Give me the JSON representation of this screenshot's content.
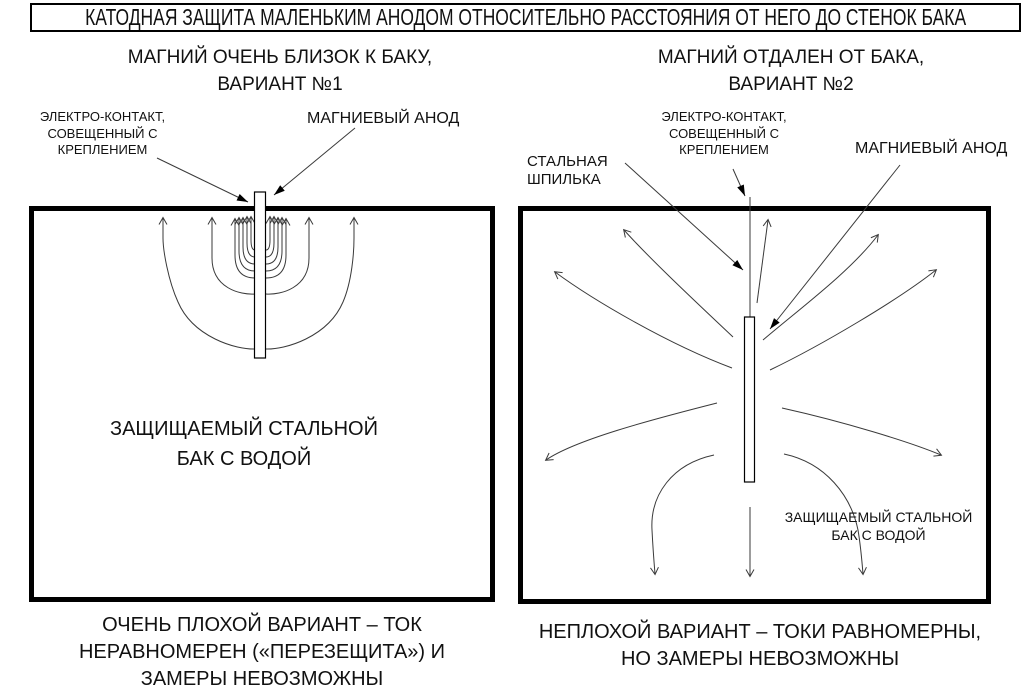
{
  "title": "КАТОДНАЯ ЗАЩИТА МАЛЕНЬКИМ АНОДОМ ОТНОСИТЕЛЬНО РАССТОЯНИЯ ОТ НЕГО ДО СТЕНОК БАКА",
  "colors": {
    "line": "#3a3a3a",
    "border": "#000000",
    "background": "#ffffff",
    "text": "#111111"
  },
  "diagram_left": {
    "heading_line1": "МАГНИЙ ОЧЕНЬ БЛИЗОК К БАКУ,",
    "heading_line2": "ВАРИАНТ №1",
    "contact_label": [
      "ЭЛЕКТРО-КОНТАКТ,",
      "СОВЕЩЕННЫЙ С",
      "КРЕПЛЕНИЕМ"
    ],
    "anode_label": "МАГНИЕВЫЙ АНОД",
    "tank_label": [
      "ЗАЩИЩАЕМЫЙ СТАЛЬНОЙ",
      "БАК С ВОДОЙ"
    ],
    "caption": [
      "ОЧЕНЬ ПЛОХОЙ ВАРИАНТ – ТОК",
      "НЕРАВНОМЕРЕН («ПЕРЕЗЕЩИТА») И",
      "ЗАМЕРЫ НЕВОЗМОЖНЫ"
    ]
  },
  "diagram_right": {
    "heading_line1": "МАГНИЙ ОТДАЛЕН ОТ БАКА,",
    "heading_line2": "ВАРИАНТ №2",
    "stud_label": [
      "СТАЛЬНАЯ",
      "ШПИЛЬКА"
    ],
    "contact_label": [
      "ЭЛЕКТРО-КОНТАКТ,",
      "СОВЕЩЕННЫЙ С",
      "КРЕПЛЕНИЕМ"
    ],
    "anode_label": "МАГНИЕВЫЙ АНОД",
    "tank_label": [
      "ЗАЩИЩАЕМЫЙ СТАЛЬНОЙ",
      "БАК С ВОДОЙ"
    ],
    "caption": [
      "НЕПЛОХОЙ ВАРИАНТ – ТОКИ РАВНОМЕРНЫ,",
      "НО ЗАМЕРЫ НЕВОЗМОЖНЫ"
    ]
  }
}
